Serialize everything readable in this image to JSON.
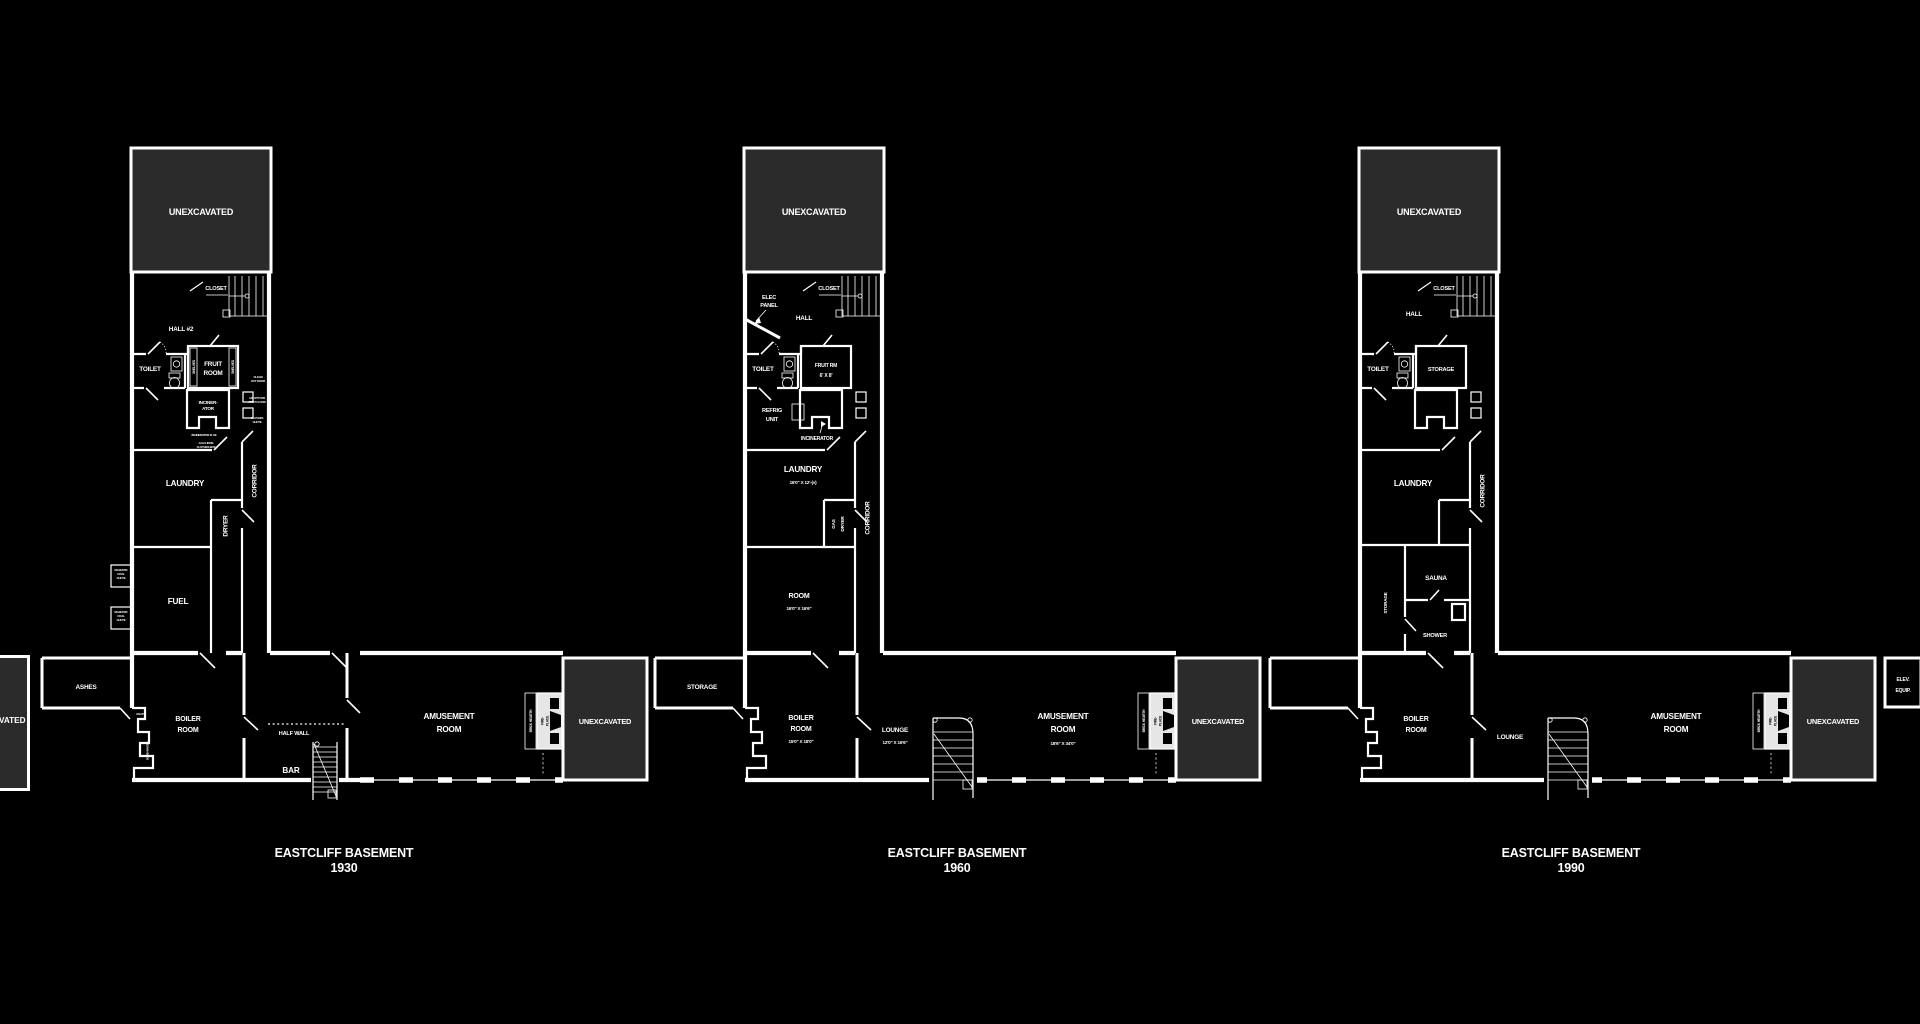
{
  "colors": {
    "background": "#000000",
    "walls": "#ffffff",
    "unexcavated_fill": "#2b2b2b"
  },
  "partial_left_plan": {
    "unexcavated": "UNEXCAVATED"
  },
  "plans": [
    {
      "title": [
        "EASTCLIFF BASEMENT",
        "1930"
      ],
      "rooms": {
        "unexcavated_top": "UNEXCAVATED",
        "closet": "CLOSET",
        "hall": "HALL #2",
        "toilet": "TOILET",
        "fruit_room": [
          "FRUIT",
          "ROOM"
        ],
        "shelves": "SHELVES",
        "clean_out_door": [
          "CLEAN",
          "OUT DOOR"
        ],
        "ash_pit_first_floor": [
          "ASH PIT FOR",
          "FIRST FLOOR"
        ],
        "clothes_chute": [
          "CLOTHES",
          "CHUTE"
        ],
        "incinerator": [
          "INCINER-",
          "ATOR"
        ],
        "incinerator_flue": "INCINERATOR FLUE",
        "galv_clothes_box": [
          "GALV. IRON",
          "CLOTHES BOX"
        ],
        "laundry": "LAUNDRY",
        "corridor": "CORRIDOR",
        "dryer": "DRYER",
        "fuel": "FUEL",
        "coal_chute": [
          "MAJESTIC",
          "COAL",
          "CHUTE"
        ],
        "ashes": "ASHES",
        "ash_pit": "ASH PIT",
        "dumb_waiter": "DUMB WAITER",
        "boiler_room": [
          "BOILER",
          "ROOM"
        ],
        "half_wall": "HALF WALL",
        "bar": "BAR",
        "amusement_room": [
          "AMUSEMENT",
          "ROOM"
        ],
        "brick_hearth": "BRICK HEARTH",
        "fireplace": [
          "FIRE-",
          "PLACE"
        ],
        "ash_pit_1st": [
          "ASH PIT FOR",
          "1ST FLOOR"
        ],
        "ash_pit_2nd": [
          "ASH PIT FOR",
          "2ND FLOOR"
        ],
        "unexcavated_right": "UNEXCAVATED"
      }
    },
    {
      "title": [
        "EASTCLIFF BASEMENT",
        "1960"
      ],
      "rooms": {
        "unexcavated_top": "UNEXCAVATED",
        "elec_panel": [
          "ELEC",
          "PANEL"
        ],
        "closet": "CLOSET",
        "hall": "HALL",
        "toilet": "TOILET",
        "fruit_rm": [
          "FRUIT RM",
          "6' X 8'"
        ],
        "refrig_unit": [
          "REFRIG",
          "UNIT"
        ],
        "incinerator": "INCINERATOR",
        "laundry": [
          "LAUNDRY",
          "16'0\" X 12'-(±)"
        ],
        "gas_dryer": [
          "GAS",
          "DRYER"
        ],
        "corridor": "CORRIDOR",
        "room": [
          "ROOM",
          "16'0\" X 16'6\""
        ],
        "storage": "STORAGE",
        "boiler_room": [
          "BOILER",
          "ROOM",
          "15'0\" X 18'0\""
        ],
        "lounge": [
          "LOUNGE",
          "12'0\" X 16'6\""
        ],
        "amusement_room": [
          "AMUSEMENT",
          "ROOM",
          "18'6\" X 34'0\""
        ],
        "brick_hearth": "BRICK HEARTH",
        "fireplace": [
          "FIRE-",
          "PLACE"
        ],
        "unexcavated_right": "UNEXCAVATED"
      }
    },
    {
      "title": [
        "EASTCLIFF BASEMENT",
        "1990"
      ],
      "rooms": {
        "unexcavated_top": "UNEXCAVATED",
        "closet": "CLOSET",
        "hall": "HALL",
        "toilet": "TOILET",
        "storage_upper": "STORAGE",
        "laundry": "LAUNDRY",
        "corridor": "CORRIDOR",
        "sauna": "SAUNA",
        "storage_side": "STORAGE",
        "shower": "SHOWER",
        "boiler_room": [
          "BOILER",
          "ROOM"
        ],
        "lounge": "LOUNGE",
        "amusement_room": [
          "AMUSEMENT",
          "ROOM"
        ],
        "brick_hearth": "BRICK HEARTH",
        "fireplace": [
          "FIRE-",
          "PLACE"
        ],
        "unexcavated_right": "UNEXCAVATED",
        "elev_equip": [
          "ELEV.",
          "EQUIP."
        ]
      }
    }
  ]
}
